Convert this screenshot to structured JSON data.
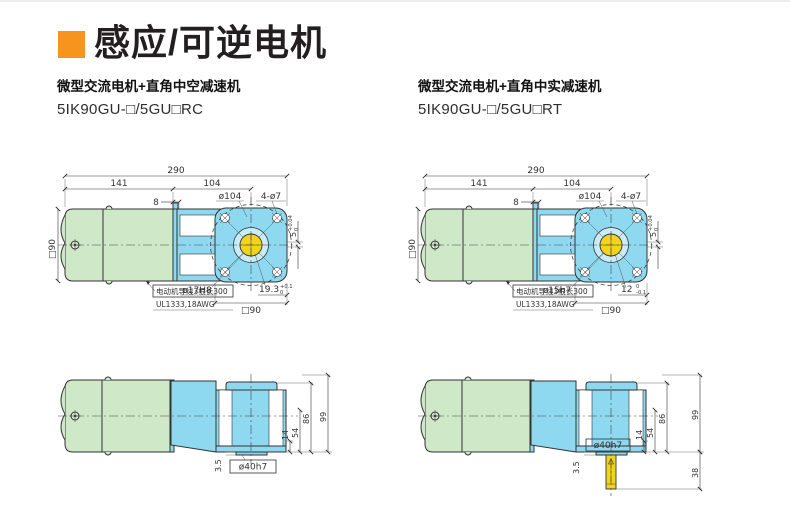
{
  "page": {
    "title": "感应/可逆电机"
  },
  "colors": {
    "accent": "#F7941D",
    "motor_fill": "#cfe8c7",
    "gearbox_fill": "#8ed8f0",
    "shaft_fill": "#f2d41c",
    "line": "#333333"
  },
  "left": {
    "subtitle": "微型交流电机+直角中空减速机",
    "model": "5IK90GU-□/5GU□RC",
    "top": {
      "overall": "290",
      "motor_len": "141",
      "gear_len": "104",
      "step": "8",
      "bolt_circle": "ø104",
      "holes": "4-ø7",
      "frame": "□90",
      "key": "5",
      "key_up": "+0.04",
      "key_dn": "0",
      "bore": "ø17H8",
      "face": "□90",
      "depth": "19.3",
      "depth_up": "+0.1",
      "depth_dn": "0",
      "note1": "电动机导线3根长300",
      "note2": "UL1333,18AWG"
    },
    "side": {
      "h99": "99",
      "h86": "86",
      "h54": "54",
      "h14": "14",
      "t": "3.5",
      "boss": "ø40h7"
    }
  },
  "right": {
    "subtitle": "微型交流电机+直角中实减速机",
    "model": "5IK90GU-□/5GU□RT",
    "top": {
      "overall": "290",
      "motor_len": "141",
      "gear_len": "104",
      "step": "8",
      "bolt_circle": "ø104",
      "holes": "4-ø7",
      "frame": "□90",
      "key": "5",
      "key_up": "+0.04",
      "key_dn": "0",
      "bore": "ø15h7",
      "face": "□90",
      "depth": "12",
      "depth_up": "0",
      "depth_dn": "-0.1",
      "note1": "电动机导线3根长300",
      "note2": "UL1333,18AWG"
    },
    "side": {
      "h99": "99",
      "h86": "86",
      "h54": "54",
      "h14": "14",
      "t": "3.5",
      "boss": "ø40h7",
      "shaft": "38"
    }
  }
}
